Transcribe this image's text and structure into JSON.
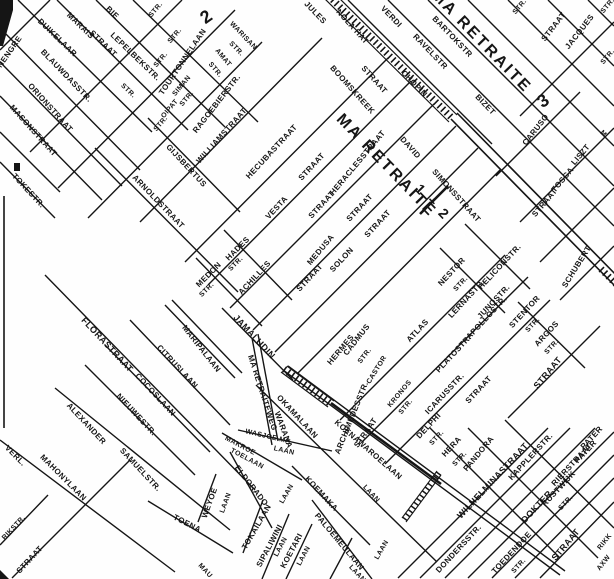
{
  "map": {
    "type": "scanned-street-map",
    "district_title": "MA RETRAITE",
    "colors": {
      "ink": "#151515",
      "paper": "#fefefe"
    },
    "labels": [
      {
        "t": "NENGRE",
        "x": 10,
        "y": 52,
        "r": -55,
        "s": 8
      },
      {
        "t": "DUIKELAAR",
        "x": 57,
        "y": 38,
        "r": 44,
        "s": 8
      },
      {
        "t": "MARAIS",
        "x": 80,
        "y": 26,
        "r": 44,
        "s": 8
      },
      {
        "t": "STRAAT",
        "x": 103,
        "y": 44,
        "r": 44,
        "s": 8
      },
      {
        "t": "BIE",
        "x": 112,
        "y": 13,
        "r": 44,
        "s": 8
      },
      {
        "t": "LEPELBEKSTR.",
        "x": 135,
        "y": 57,
        "r": 44,
        "s": 8
      },
      {
        "t": "STR.",
        "x": 128,
        "y": 91,
        "r": 44,
        "s": 7
      },
      {
        "t": "BLAUWDASSTR.",
        "x": 66,
        "y": 76,
        "r": 46,
        "s": 8
      },
      {
        "t": "ORIONSTRAAT",
        "x": 50,
        "y": 108,
        "r": 48,
        "s": 8
      },
      {
        "t": "MASONSTRAAT",
        "x": 33,
        "y": 131,
        "r": 48,
        "s": 8
      },
      {
        "t": "TOKESTR.",
        "x": 28,
        "y": 191,
        "r": 47,
        "s": 8
      },
      {
        "t": "STR.",
        "x": 156,
        "y": 10,
        "r": -50,
        "s": 7
      },
      {
        "t": "STR.",
        "x": 175,
        "y": 36,
        "r": -50,
        "s": 7
      },
      {
        "t": "STR.",
        "x": 161,
        "y": 60,
        "r": -50,
        "s": 7
      },
      {
        "t": "TOURTONNELAAN",
        "x": 183,
        "y": 62,
        "r": -56,
        "s": 8
      },
      {
        "t": "SIMAN",
        "x": 182,
        "y": 86,
        "r": -50,
        "s": 7
      },
      {
        "t": "STR.",
        "x": 187,
        "y": 99,
        "r": -50,
        "s": 7
      },
      {
        "t": "OIPAT",
        "x": 170,
        "y": 109,
        "r": -50,
        "s": 7
      },
      {
        "t": "STR.",
        "x": 161,
        "y": 124,
        "r": -50,
        "s": 7
      },
      {
        "t": "RAGOEBIERSTR.",
        "x": 217,
        "y": 104,
        "r": -52,
        "s": 8
      },
      {
        "t": "WARISAN",
        "x": 243,
        "y": 36,
        "r": 46,
        "s": 7
      },
      {
        "t": "STR.",
        "x": 236,
        "y": 49,
        "r": 46,
        "s": 7
      },
      {
        "t": "AMAT",
        "x": 223,
        "y": 58,
        "r": 50,
        "s": 7
      },
      {
        "t": "STR.",
        "x": 215,
        "y": 70,
        "r": 50,
        "s": 7
      },
      {
        "t": "2",
        "x": 207,
        "y": 16,
        "r": -35,
        "s": 18,
        "b": 1
      },
      {
        "t": "JULES",
        "x": 315,
        "y": 13,
        "r": 46,
        "s": 8
      },
      {
        "t": "NOLA HAT",
        "x": 352,
        "y": 27,
        "r": 48,
        "s": 8
      },
      {
        "t": "VERDI",
        "x": 391,
        "y": 17,
        "r": 46,
        "s": 8
      },
      {
        "t": "STR.",
        "x": 520,
        "y": 7,
        "r": -50,
        "s": 7
      },
      {
        "t": "STR.",
        "x": 608,
        "y": 6,
        "r": -50,
        "s": 7
      },
      {
        "t": "STRAAT",
        "x": 554,
        "y": 27,
        "r": -52,
        "s": 8
      },
      {
        "t": "JACQUES",
        "x": 580,
        "y": 32,
        "r": -52,
        "s": 8
      },
      {
        "t": "STR.",
        "x": 608,
        "y": 57,
        "r": -50,
        "s": 7
      },
      {
        "t": "BARTOKSTR",
        "x": 452,
        "y": 37,
        "r": 46,
        "s": 8
      },
      {
        "t": "RAVELSTR",
        "x": 430,
        "y": 52,
        "r": 46,
        "s": 8
      },
      {
        "t": "CHOPIN",
        "x": 414,
        "y": 84,
        "r": 46,
        "s": 8
      },
      {
        "t": "BIZET",
        "x": 485,
        "y": 105,
        "r": 46,
        "s": 8
      },
      {
        "t": "MA RETRAITE",
        "x": 481,
        "y": 42,
        "r": 46,
        "s": 16,
        "b": 1
      },
      {
        "t": "3",
        "x": 544,
        "y": 100,
        "r": -35,
        "s": 18,
        "b": 1
      },
      {
        "t": "CARUSO",
        "x": 536,
        "y": 130,
        "r": -52,
        "s": 8
      },
      {
        "t": "LISZT",
        "x": 581,
        "y": 155,
        "r": -50,
        "s": 8
      },
      {
        "t": "TOSCA",
        "x": 563,
        "y": 180,
        "r": -50,
        "s": 8
      },
      {
        "t": "STRAAT",
        "x": 545,
        "y": 203,
        "r": -50,
        "s": 8
      },
      {
        "t": "SCHUBERT",
        "x": 577,
        "y": 267,
        "r": -58,
        "s": 8
      },
      {
        "t": "M",
        "x": 603,
        "y": 134,
        "r": 45,
        "s": 7
      },
      {
        "t": "BOOMSKREEK",
        "x": 352,
        "y": 90,
        "r": 48,
        "s": 8
      },
      {
        "t": "STRAAT",
        "x": 374,
        "y": 80,
        "r": 48,
        "s": 8
      },
      {
        "t": "DAVID",
        "x": 410,
        "y": 148,
        "r": 48,
        "s": 8
      },
      {
        "t": "SIMONSSTRAAT",
        "x": 456,
        "y": 196,
        "r": 48,
        "s": 8
      },
      {
        "t": "MA RETRAITE",
        "x": 386,
        "y": 166,
        "r": 46,
        "s": 16,
        "b": 1
      },
      {
        "t": "1 + 2",
        "x": 433,
        "y": 202,
        "r": 46,
        "s": 14,
        "b": 1
      },
      {
        "t": "GIJSBERTUS",
        "x": 186,
        "y": 166,
        "r": 47,
        "s": 8
      },
      {
        "t": "ARNOLDSTRAAT",
        "x": 158,
        "y": 202,
        "r": 46,
        "s": 8
      },
      {
        "t": "WILLIAMSTRAAT",
        "x": 222,
        "y": 136,
        "r": -48,
        "s": 8
      },
      {
        "t": "HECUBASTRAAT",
        "x": 272,
        "y": 152,
        "r": -47,
        "s": 8
      },
      {
        "t": "VESTA",
        "x": 277,
        "y": 208,
        "r": -47,
        "s": 8
      },
      {
        "t": "STRAAT",
        "x": 312,
        "y": 167,
        "r": -47,
        "s": 8
      },
      {
        "t": "STRAAT",
        "x": 322,
        "y": 205,
        "r": -47,
        "s": 8
      },
      {
        "t": "MEDUSA",
        "x": 321,
        "y": 250,
        "r": -50,
        "s": 8
      },
      {
        "t": "STRAAT",
        "x": 360,
        "y": 208,
        "r": -47,
        "s": 8
      },
      {
        "t": "SOLON",
        "x": 342,
        "y": 260,
        "r": -47,
        "s": 8
      },
      {
        "t": "STRAAT",
        "x": 378,
        "y": 224,
        "r": -47,
        "s": 8
      },
      {
        "t": "HERACLESSTRAAT",
        "x": 358,
        "y": 163,
        "r": -50,
        "s": 8
      },
      {
        "t": "HADES",
        "x": 238,
        "y": 249,
        "r": -45,
        "s": 8
      },
      {
        "t": "STR.",
        "x": 236,
        "y": 264,
        "r": -45,
        "s": 7
      },
      {
        "t": "MEDON",
        "x": 209,
        "y": 275,
        "r": -45,
        "s": 8
      },
      {
        "t": "STR.",
        "x": 207,
        "y": 290,
        "r": -45,
        "s": 7
      },
      {
        "t": "ACHILLES",
        "x": 255,
        "y": 278,
        "r": -47,
        "s": 8
      },
      {
        "t": "STRAAT",
        "x": 310,
        "y": 278,
        "r": -47,
        "s": 8
      },
      {
        "t": "ATLAS",
        "x": 418,
        "y": 331,
        "r": -47,
        "s": 8
      },
      {
        "t": "NESTOR",
        "x": 452,
        "y": 272,
        "r": -47,
        "s": 8
      },
      {
        "t": "STR.",
        "x": 461,
        "y": 284,
        "r": -47,
        "s": 7
      },
      {
        "t": "HELICONSTR.",
        "x": 500,
        "y": 267,
        "r": -47,
        "s": 8
      },
      {
        "t": "LERNASTR.",
        "x": 467,
        "y": 299,
        "r": -47,
        "s": 8
      },
      {
        "t": "JUNOSTR.",
        "x": 494,
        "y": 302,
        "r": -47,
        "s": 8
      },
      {
        "t": "APOLLOSTR.",
        "x": 487,
        "y": 318,
        "r": -47,
        "s": 8
      },
      {
        "t": "STENTOR",
        "x": 525,
        "y": 312,
        "r": -47,
        "s": 8
      },
      {
        "t": "STR.",
        "x": 533,
        "y": 325,
        "r": -47,
        "s": 7
      },
      {
        "t": "ARGOS",
        "x": 547,
        "y": 334,
        "r": -47,
        "s": 8
      },
      {
        "t": "STR.",
        "x": 552,
        "y": 347,
        "r": -47,
        "s": 7
      },
      {
        "t": "STRAAT",
        "x": 548,
        "y": 373,
        "r": -50,
        "s": 9
      },
      {
        "t": "PLATOSTR.",
        "x": 454,
        "y": 354,
        "r": -47,
        "s": 8
      },
      {
        "t": "STRAAT",
        "x": 479,
        "y": 390,
        "r": -47,
        "s": 8
      },
      {
        "t": "ICARUSSTR.",
        "x": 445,
        "y": 394,
        "r": -47,
        "s": 8
      },
      {
        "t": "KRONOS",
        "x": 400,
        "y": 394,
        "r": -50,
        "s": 7
      },
      {
        "t": "STR.",
        "x": 406,
        "y": 407,
        "r": -50,
        "s": 7
      },
      {
        "t": "CASTOR",
        "x": 377,
        "y": 370,
        "r": -58,
        "s": 7
      },
      {
        "t": "CADMUS",
        "x": 357,
        "y": 340,
        "r": -52,
        "s": 8
      },
      {
        "t": "STR.",
        "x": 365,
        "y": 356,
        "r": -52,
        "s": 7
      },
      {
        "t": "HERMES",
        "x": 341,
        "y": 350,
        "r": -50,
        "s": 8
      },
      {
        "t": "ARCHIMEDESSTR.",
        "x": 352,
        "y": 418,
        "r": -68,
        "s": 8
      },
      {
        "t": "STRAAT",
        "x": 366,
        "y": 433,
        "r": -55,
        "s": 8
      },
      {
        "t": "DELPHI",
        "x": 429,
        "y": 426,
        "r": -47,
        "s": 8
      },
      {
        "t": "STR.",
        "x": 437,
        "y": 438,
        "r": -47,
        "s": 7
      },
      {
        "t": "HERA",
        "x": 452,
        "y": 447,
        "r": -47,
        "s": 8
      },
      {
        "t": "STR.",
        "x": 460,
        "y": 459,
        "r": -47,
        "s": 7
      },
      {
        "t": "PANDORA",
        "x": 479,
        "y": 454,
        "r": -50,
        "s": 8
      },
      {
        "t": "WILHELMINASTRAAT",
        "x": 493,
        "y": 481,
        "r": -47,
        "s": 9
      },
      {
        "t": "KAPPLERSTR.",
        "x": 531,
        "y": 457,
        "r": -47,
        "s": 8
      },
      {
        "t": "RIERSTRAAT",
        "x": 572,
        "y": 465,
        "r": -47,
        "s": 8
      },
      {
        "t": "RUSTWIJK",
        "x": 559,
        "y": 489,
        "r": -47,
        "s": 8
      },
      {
        "t": "STR.",
        "x": 566,
        "y": 503,
        "r": -47,
        "s": 7
      },
      {
        "t": "PATER",
        "x": 592,
        "y": 438,
        "r": -47,
        "s": 8
      },
      {
        "t": "PATER",
        "x": 586,
        "y": 452,
        "r": -47,
        "s": 8
      },
      {
        "t": "DOKTER",
        "x": 537,
        "y": 507,
        "r": -47,
        "s": 9
      },
      {
        "t": "STRAAT",
        "x": 566,
        "y": 545,
        "r": -50,
        "s": 9
      },
      {
        "t": "DONDERSSTR.",
        "x": 459,
        "y": 549,
        "r": -47,
        "s": 8
      },
      {
        "t": "TOEDENDOE",
        "x": 512,
        "y": 553,
        "r": -47,
        "s": 8
      },
      {
        "t": "STR.",
        "x": 519,
        "y": 566,
        "r": -47,
        "s": 7
      },
      {
        "t": "RIKK",
        "x": 605,
        "y": 542,
        "r": -52,
        "s": 7
      },
      {
        "t": "AXW",
        "x": 604,
        "y": 563,
        "r": -52,
        "s": 7
      },
      {
        "t": "JAMALUDIN",
        "x": 254,
        "y": 337,
        "r": 47,
        "s": 9
      },
      {
        "t": "MARIPALAAN",
        "x": 201,
        "y": 349,
        "r": 52,
        "s": 8
      },
      {
        "t": "CITRUSLAAN",
        "x": 177,
        "y": 367,
        "r": 47,
        "s": 8
      },
      {
        "t": "COCOSLAAN",
        "x": 155,
        "y": 395,
        "r": 47,
        "s": 8
      },
      {
        "t": "NIEUWESTR.",
        "x": 136,
        "y": 415,
        "r": 47,
        "s": 8
      },
      {
        "t": "ALEXANDER",
        "x": 86,
        "y": 424,
        "r": 47,
        "s": 8
      },
      {
        "t": "SAMUELSTR.",
        "x": 140,
        "y": 470,
        "r": 47,
        "s": 8
      },
      {
        "t": "FLORASTRAAT",
        "x": 107,
        "y": 345,
        "r": 47,
        "s": 9
      },
      {
        "t": "VERL.",
        "x": 15,
        "y": 456,
        "r": 45,
        "s": 8
      },
      {
        "t": "MAHONYLAAN",
        "x": 63,
        "y": 478,
        "r": 45,
        "s": 8
      },
      {
        "t": "TOENA",
        "x": 187,
        "y": 524,
        "r": 27,
        "s": 8
      },
      {
        "t": "RIKSTR.",
        "x": 14,
        "y": 528,
        "r": -47,
        "s": 7
      },
      {
        "t": "STRAAT",
        "x": 30,
        "y": 560,
        "r": -47,
        "s": 8
      },
      {
        "t": "MA RETRAITEWEG",
        "x": 262,
        "y": 393,
        "r": 72,
        "s": 8
      },
      {
        "t": "OKAMALAAN",
        "x": 297,
        "y": 417,
        "r": 47,
        "s": 8
      },
      {
        "t": "WARANA",
        "x": 283,
        "y": 430,
        "r": 70,
        "s": 8
      },
      {
        "t": "KOENAWAROELAAN",
        "x": 368,
        "y": 450,
        "r": 41,
        "s": 8
      },
      {
        "t": "WASJOE MA",
        "x": 268,
        "y": 437,
        "r": 13,
        "s": 7
      },
      {
        "t": "LAAN",
        "x": 284,
        "y": 451,
        "r": 13,
        "s": 7
      },
      {
        "t": "MAKROE",
        "x": 240,
        "y": 446,
        "r": 28,
        "s": 7
      },
      {
        "t": "TOELAAN",
        "x": 247,
        "y": 459,
        "r": 28,
        "s": 7
      },
      {
        "t": "ELDORADO",
        "x": 251,
        "y": 486,
        "r": 52,
        "s": 8
      },
      {
        "t": "LAAN",
        "x": 287,
        "y": 494,
        "r": -60,
        "s": 7
      },
      {
        "t": "WEYOE",
        "x": 210,
        "y": 503,
        "r": -70,
        "s": 8
      },
      {
        "t": "LAAN",
        "x": 226,
        "y": 503,
        "r": -70,
        "s": 7
      },
      {
        "t": "TOKAILAAN",
        "x": 257,
        "y": 527,
        "r": -60,
        "s": 8
      },
      {
        "t": "SIPALIWINI",
        "x": 270,
        "y": 546,
        "r": -62,
        "s": 8
      },
      {
        "t": "LAAN",
        "x": 281,
        "y": 547,
        "r": -62,
        "s": 7
      },
      {
        "t": "KOETARI",
        "x": 292,
        "y": 551,
        "r": -62,
        "s": 8
      },
      {
        "t": "LAAN",
        "x": 304,
        "y": 556,
        "r": -62,
        "s": 7
      },
      {
        "t": "KOEMAKA",
        "x": 321,
        "y": 494,
        "r": 47,
        "s": 8
      },
      {
        "t": "LAAN",
        "x": 371,
        "y": 494,
        "r": 47,
        "s": 7
      },
      {
        "t": "PALOEMEULAAN",
        "x": 339,
        "y": 542,
        "r": 50,
        "s": 8
      },
      {
        "t": "LAAN",
        "x": 382,
        "y": 550,
        "r": -60,
        "s": 7
      },
      {
        "t": "LAAN",
        "x": 357,
        "y": 574,
        "r": 47,
        "s": 7
      },
      {
        "t": "MAU",
        "x": 205,
        "y": 571,
        "r": 47,
        "s": 7
      }
    ]
  }
}
